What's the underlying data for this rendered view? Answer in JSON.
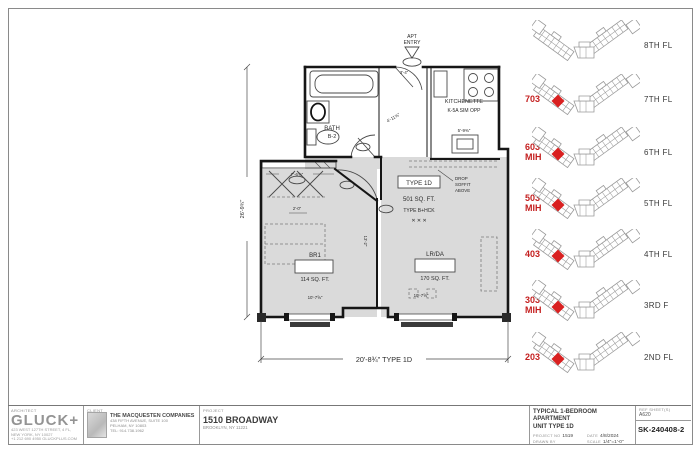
{
  "palette": {
    "wall": "#161616",
    "thin_line": "#4a4a4a",
    "unit_fill": "#dadada",
    "highlight_red": "#d92020",
    "label_red": "#c41f1f",
    "keyplan_line": "#9a9a9a"
  },
  "floor_plan": {
    "entry": {
      "line1": "APT",
      "line2": "ENTRY"
    },
    "bath": {
      "name": "BATH",
      "number": "B-2"
    },
    "kitchen": {
      "name": "KITCHENETTE",
      "spec": "K-5A SIM OPP",
      "dim": "5'-9⅜\""
    },
    "bedroom": {
      "name": "BR1",
      "area": "114 SQ. FT."
    },
    "living": {
      "name": "LR/DA",
      "area": "170 SQ. FT."
    },
    "unit": {
      "type": "TYPE 1D",
      "area": "501 SQ. FT.",
      "prior_type": "TYPE B+HCK"
    },
    "soffit": {
      "l1": "DROP",
      "l2": "SOFFIT",
      "l3": "ABOVE"
    },
    "dims": {
      "overall_width": "20'-8¾\" TYPE 1D",
      "overall_height": "26'-9¾\"",
      "closet": "7'-6⅝\"",
      "bedroom_width": "10'-7⅝\"",
      "living_width": "10'-7⅝\"",
      "entry_depth": "4'-11⅝\"",
      "hall_width": "3'-4\"",
      "bath_door": "2'-0\"",
      "hall_length": "13'-2\""
    }
  },
  "key_plans": {
    "floors": [
      {
        "floor": "8TH FL",
        "unit": "",
        "mih_label": "",
        "highlight": false
      },
      {
        "floor": "7TH FL",
        "unit": "703",
        "mih_label": "",
        "highlight": true
      },
      {
        "floor": "6TH FL",
        "unit": "603",
        "mih_label": "MIH",
        "highlight": true
      },
      {
        "floor": "5TH FL",
        "unit": "503",
        "mih_label": "MIH",
        "highlight": true
      },
      {
        "floor": "4TH FL",
        "unit": "403",
        "mih_label": "",
        "highlight": true
      },
      {
        "floor": "3RD F",
        "unit": "303",
        "mih_label": "MIH",
        "highlight": true
      },
      {
        "floor": "2ND FL",
        "unit": "203",
        "mih_label": "",
        "highlight": true
      }
    ]
  },
  "title_block": {
    "architect": {
      "label": "ARCHITECT",
      "logo": "GLUCK+",
      "addr1": "423 WEST 127TH STREET, 4 FL, NEW YORK, NY 10027",
      "addr2": "+1 212 690 4950  GLUCKPLUS.COM"
    },
    "client": {
      "label": "CLIENT",
      "name": "THE MACQUESTEN COMPANIES",
      "addr1": "438 FIFTH AVENUE, SUITE 100",
      "addr2": "PELHAM, NY 10803",
      "addr3": "TEL: 914.738.1962"
    },
    "project": {
      "label": "PROJECT",
      "name": "1510 BROADWAY",
      "addr": "BROOKLYN, NY 11221"
    },
    "sheet_title": {
      "line1": "TYPICAL 1-BEDROOM APARTMENT",
      "line2": "UNIT TYPE 1D"
    },
    "meta": {
      "project_no_label": "PROJECT NO",
      "project_no": "1519",
      "date_label": "DATE",
      "date": "4/8/2024",
      "drawn_label": "DRAWN BY",
      "drawn": "",
      "scale_label": "SCALE",
      "scale": "1/4\"=1'-0\""
    },
    "ref": {
      "label": "REF SHEET(S)",
      "value": "A620"
    },
    "sheet_no": "SK-240408-2"
  }
}
